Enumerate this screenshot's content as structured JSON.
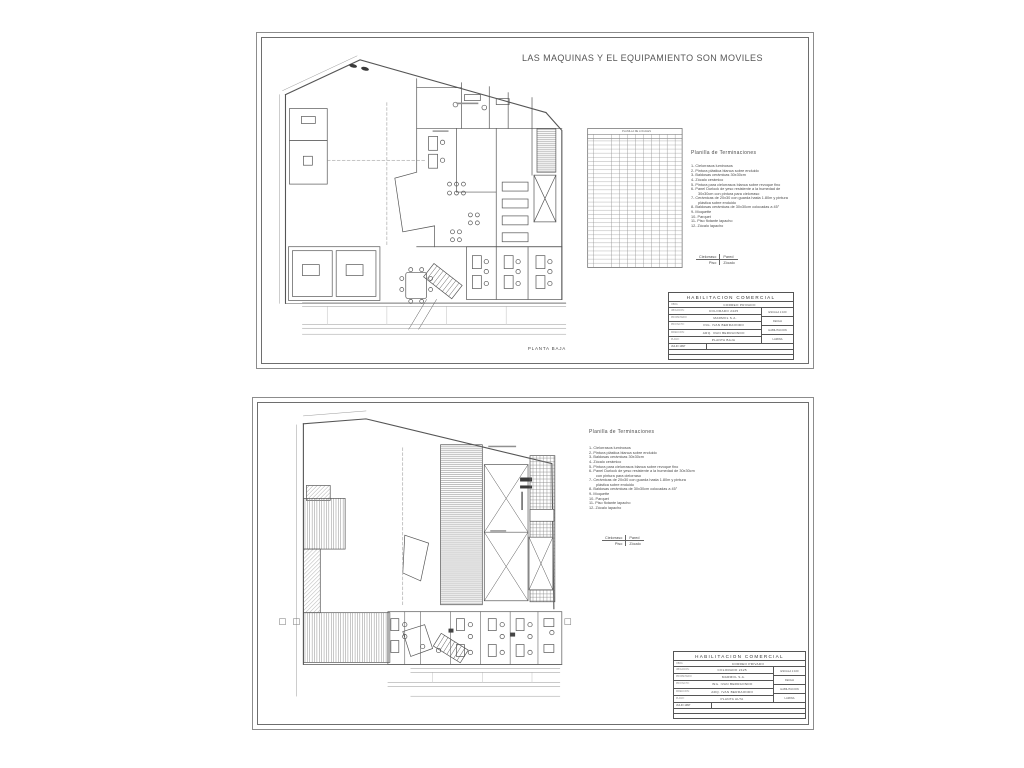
{
  "colors": {
    "line": "#555555",
    "hatch": "#8a8a8a",
    "text": "#4a4a4a",
    "paper": "#ffffff"
  },
  "finishes": {
    "heading": "Planilla de Terminaciones",
    "items": [
      "1- Cielorrasos luminosos",
      "2- Pintura plástica blanca sobre enduido",
      "3- Baldosas cerámicas 30x30cm",
      "4- Zócalo cerámico",
      "5- Pintura para cielorrasos blanca sobre revoque fino",
      "6- Panel Durlock de yeso resistente a la humedad de 30x30cm con pintura para cielorraso",
      "7- Cerámicas de 20x30 con guarda hasta 1.80m y pintura plástica sobre enduido",
      "8- Baldosas cerámicas de 30x30cm colocadas a 45°",
      "9- Moquette",
      "10- Parquet",
      "11- Piso flotante lapacho",
      "12- Zócalo lapacho"
    ],
    "key": {
      "ceiling": "Cielorraso",
      "wall": "Pared",
      "floor": "Piso",
      "base": "Zócalo"
    }
  },
  "sheets": {
    "top": {
      "banner": "LAS MAQUINAS Y EL EQUIPAMIENTO SON MOVILES",
      "plan_label": "PLANTA BAJA",
      "schedule_title": "PLANILLA DE LOCALES",
      "titleblock": {
        "title": "HABILITACION COMERCIAL",
        "subject_label": "OBRA:",
        "subject": "CORREO PRIVADO",
        "rows": [
          {
            "label": "UBICACION:",
            "value": "COLORADO 2425"
          },
          {
            "label": "PROPIETARIO:",
            "value": "MARMOL S.A."
          },
          {
            "label": "PROYECTO:",
            "value": "ING. IVAN BERRAONDO"
          },
          {
            "label": "DIRECCION:",
            "value": "ARQ. IVAN BERRAONDO"
          },
          {
            "label": "PLANO:",
            "value": "PLANTA BAJA"
          }
        ],
        "side": [
          "ESCALA 1:100",
          "FECHA",
          "HABILITACION",
          "LAMINA"
        ],
        "date": "JULIO 1997"
      }
    },
    "bottom": {
      "titleblock": {
        "title": "HABILITACION COMERCIAL",
        "subject_label": "OBRA:",
        "subject": "CORREO PRIVADO",
        "rows": [
          {
            "label": "UBICACION:",
            "value": "COLORADO 2425"
          },
          {
            "label": "PROPIETARIO:",
            "value": "MARMOL S.A."
          },
          {
            "label": "PROYECTO:",
            "value": "ING. IVAN BERRAONDO"
          },
          {
            "label": "DIRECCION:",
            "value": "ARQ. IVAN BERRAONDO"
          },
          {
            "label": "PLANO:",
            "value": "PLANTA ALTA"
          }
        ],
        "side": [
          "ESCALA 1:100",
          "FECHA",
          "HABILITACION",
          "LAMINA"
        ],
        "date": "JULIO 1997"
      }
    }
  }
}
